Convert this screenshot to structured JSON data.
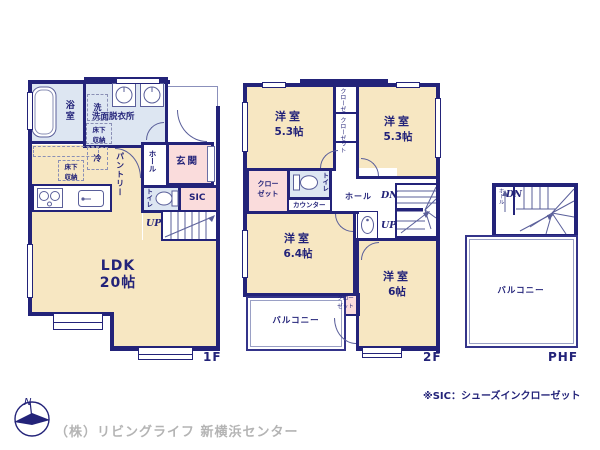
{
  "colors": {
    "wall": "#232379",
    "room_cream": "#f7e7c2",
    "pink": "#fadcdc",
    "light_blue": "#dde6f2",
    "gray_text": "#b4b4b4"
  },
  "floor1f": {
    "floor_label": "1F",
    "bath": "浴室",
    "laundry": "洗",
    "washroom": "洗面脱衣所",
    "underfloor_storage_1": "床下収納",
    "underfloor_storage_2": "床下収納",
    "fridge": "冷",
    "pantry": "パントリー",
    "hall": "ホール",
    "entrance": "玄関",
    "toilet": "トイレ",
    "sic": "SIC",
    "up": "UP",
    "ldk_name": "LDK",
    "ldk_size": "20帖"
  },
  "floor2f": {
    "floor_label": "2F",
    "bedroom1_name": "洋室",
    "bedroom1_size": "5.3帖",
    "bedroom2_name": "洋室",
    "bedroom2_size": "5.3帖",
    "closet_top_a": "クローゼット",
    "closet_top_b": "クローゼット",
    "closet_left": "クローゼット",
    "toilet": "トイレ",
    "counter": "カウンター",
    "hall": "ホール",
    "dn": "DN",
    "up": "UP",
    "bedroom3_name": "洋室",
    "bedroom3_size": "6.4帖",
    "closet_small": "クローゼット",
    "bedroom4_name": "洋室",
    "bedroom4_size": "6帖",
    "balcony": "バルコニー"
  },
  "floorphf": {
    "floor_label": "PHF",
    "hall": "ホール",
    "dn": "DN",
    "balcony": "バルコニー"
  },
  "footer": {
    "compass_n": "N",
    "company": "（株）リビングライフ 新横浜センター",
    "sic_note": "※SIC：シューズインクローゼット"
  }
}
